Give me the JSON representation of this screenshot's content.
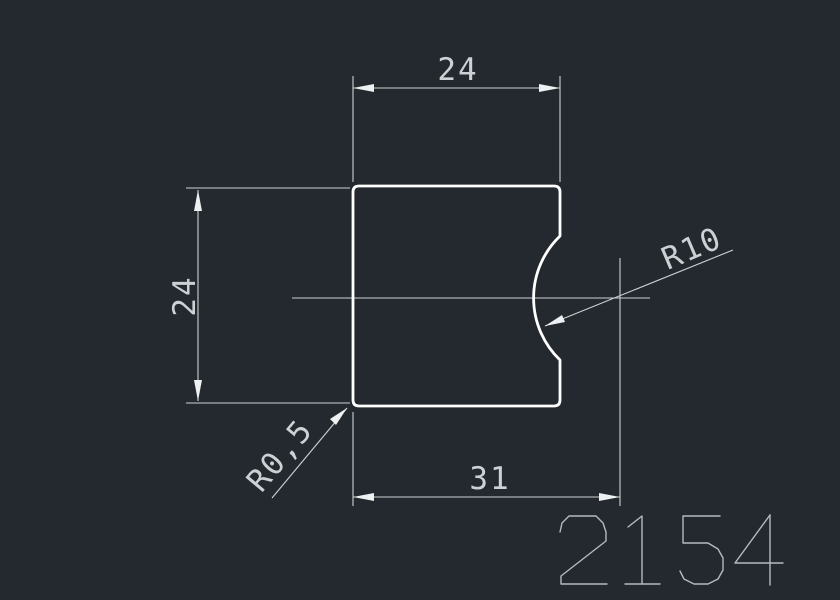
{
  "colors": {
    "background": "#242930",
    "outline": "#ffffff",
    "dimension": "#cdd1d4",
    "dimension_bright": "#eef0f1",
    "part_number": "#b6babd"
  },
  "dimensions": {
    "top_width": "24",
    "left_height": "24",
    "bottom_width": "31",
    "notch_radius": "R10",
    "corner_fillet": "R0,5"
  },
  "part_number": "2154"
}
